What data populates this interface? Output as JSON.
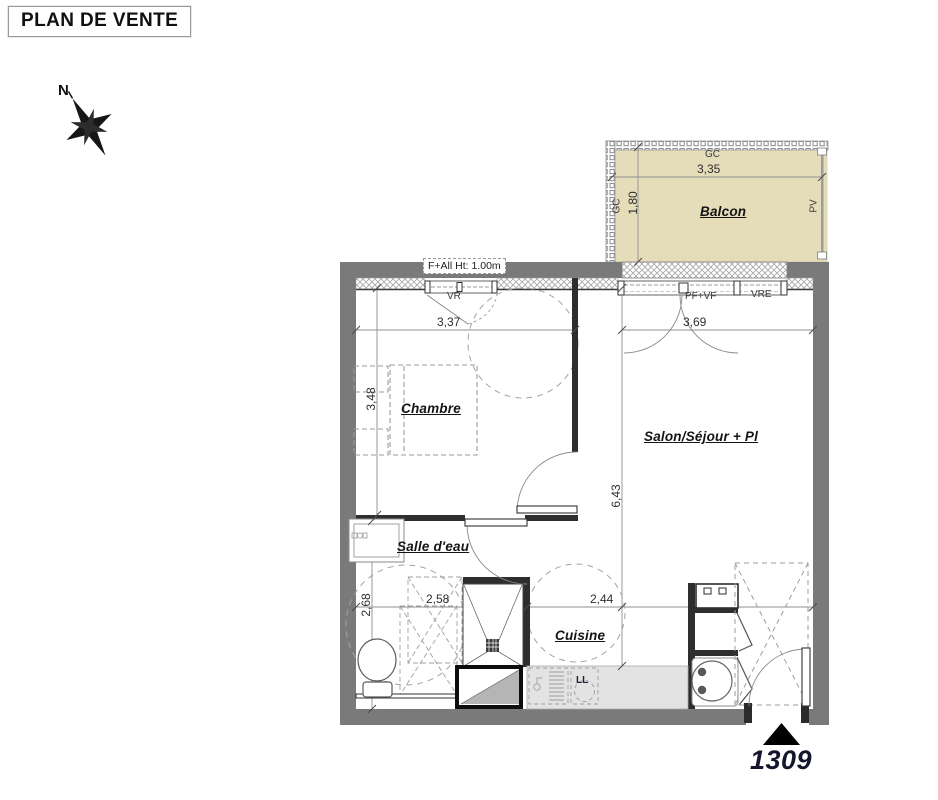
{
  "page_title": "PLAN DE VENTE",
  "compass": {
    "north": "N"
  },
  "balcony": {
    "name": "Balcon",
    "rail_top_label": "GC",
    "rail_left_label": "GC",
    "privacy_screen_label": "PV",
    "width": "3,35",
    "depth": "1,80"
  },
  "rooms": {
    "bedroom": "Chambre",
    "living_room": "Salon/Séjour + Pl",
    "shower_room": "Salle d'eau",
    "kitchen": "Cuisine"
  },
  "dimensions": {
    "bedroom_width": "3,37",
    "living_room_width": "3,69",
    "bedroom_depth": "3,48",
    "living_room_depth": "6,43",
    "shower_room_depth": "2,68",
    "shower_room_width": "2,58",
    "kitchen_width": "2,44"
  },
  "openings": {
    "bedroom_window_note": "F+All Ht: 1.00m",
    "bedroom_window": "VR",
    "balcony_door": "PF+VF",
    "living_room_window": "VRE"
  },
  "fixtures": {
    "washing_machine": "LL"
  },
  "lot_number": "1309",
  "colors": {
    "balcony_fill": "#e5dcba",
    "exterior_wall": "#7a7a7a",
    "interior_wall": "#2e2e2e",
    "kitchen_counter": "#e3e3e3"
  }
}
